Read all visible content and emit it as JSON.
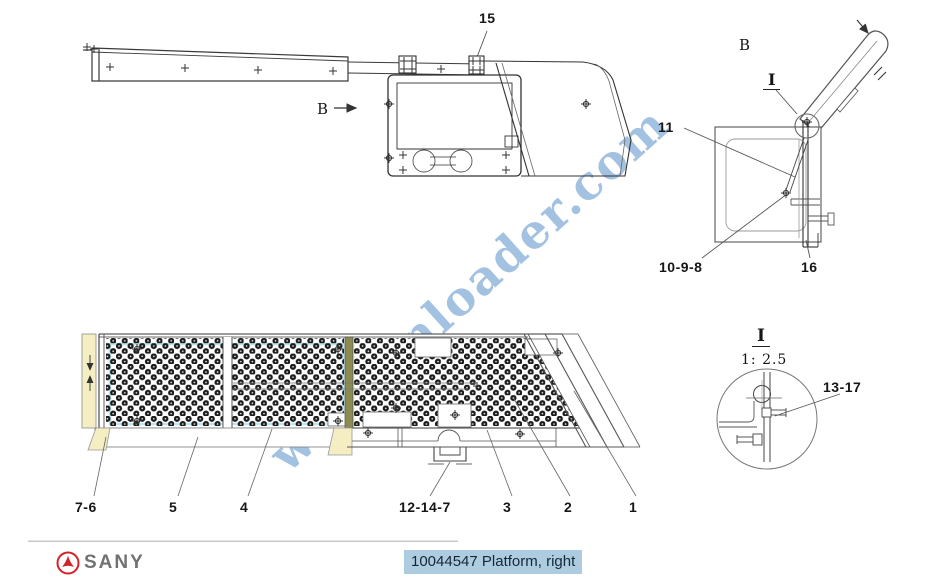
{
  "watermark": {
    "text": "www.cnloader.com",
    "color": "#6f9fd0"
  },
  "footer": {
    "brand": "SANY",
    "part_title": "10044547 Platform, right",
    "title_highlight_color": "#adccdf",
    "brand_red": "#d2232a",
    "brand_gray": "#717274"
  },
  "callouts": {
    "item_15": "15",
    "view_b_arrow": "B",
    "view_b_label": "B",
    "detail_i_marker": "I",
    "item_11": "11",
    "item_10_9_8": "10-9-8",
    "item_16": "16",
    "item_7_6": "7-6",
    "item_5": "5",
    "item_4": "4",
    "item_12_14_7": "12-14-7",
    "item_3": "3",
    "item_2": "2",
    "item_1": "1",
    "detail_i_ref": "I",
    "detail_i_scale": "1: 2.5",
    "item_13_17": "13-17"
  },
  "highlight_colors": {
    "panel_cream": "#f4eec2",
    "panel_cyan": "#bfe6ef",
    "panel_olive": "#8c8c52"
  }
}
